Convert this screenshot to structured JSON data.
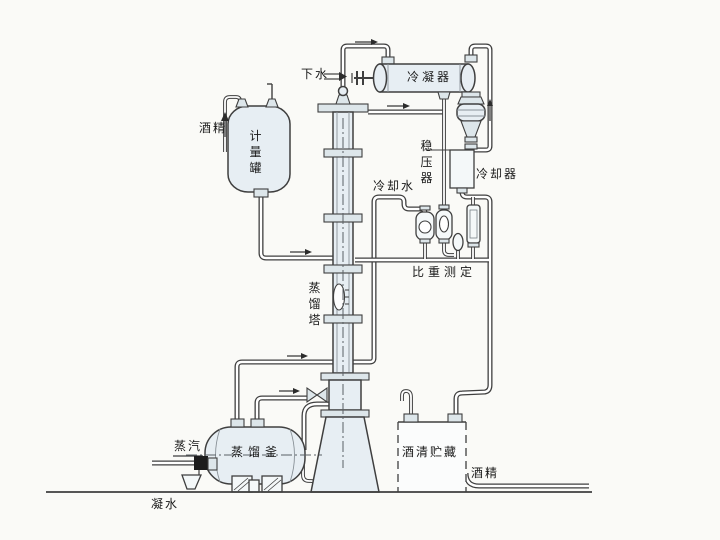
{
  "diagram": {
    "labels": {
      "drain_water": "下水",
      "condenser": "冷凝器",
      "pressure_stabilizer": "稳压器",
      "cooling_water": "冷却水",
      "cooler": "冷却器",
      "gravity_measurement": "比重测定",
      "alcohol_feed": "酒精",
      "metering_tank": "计量罐",
      "distillation_column": "蒸馏塔",
      "distillation_kettle": "蒸馏釜",
      "steam": "蒸汽",
      "condensate_water": "凝水",
      "alcohol_storage": "酒清贮藏",
      "alcohol_out": "酒精"
    },
    "colors": {
      "line": "#3f3f3f",
      "vessel_fill": "#e7eef3",
      "background": "#fafaf7",
      "text": "#1a1a1a"
    }
  }
}
